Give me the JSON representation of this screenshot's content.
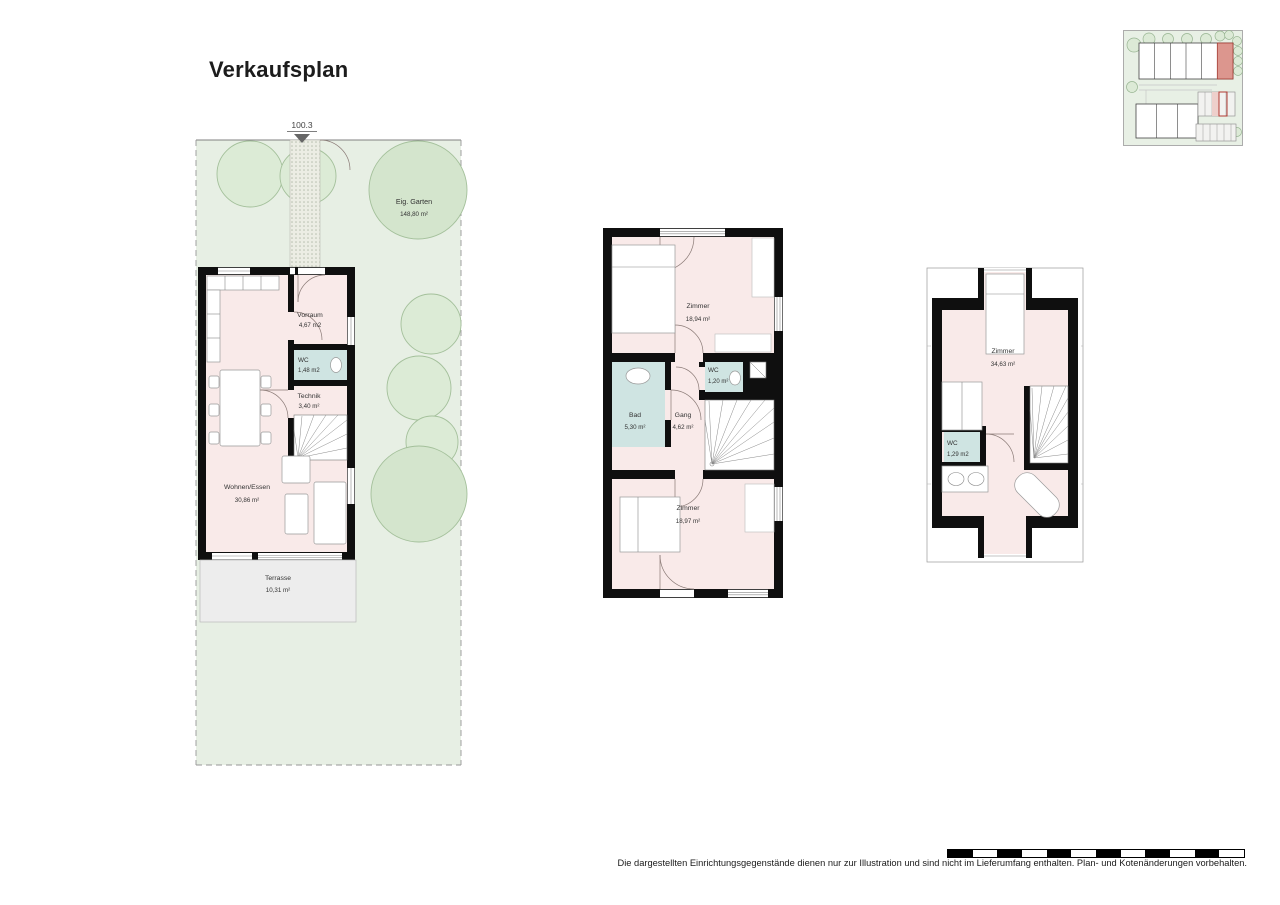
{
  "title": "Verkaufsplan",
  "site_boundary_dimension": "100.3",
  "garden": {
    "name": "Eig. Garten",
    "area": "148,80 m²"
  },
  "ground_floor": {
    "vorraum": {
      "name": "Vorraum",
      "area": "4,67 m2"
    },
    "wc": {
      "name": "WC",
      "area": "1,48 m2"
    },
    "technik": {
      "name": "Technik",
      "area": "3,40 m²"
    },
    "wohnen": {
      "name": "Wohnen/Essen",
      "area": "30,86 m²"
    },
    "terrasse": {
      "name": "Terrasse",
      "area": "10,31 m²"
    }
  },
  "upper_floor": {
    "zimmer1": {
      "name": "Zimmer",
      "area": "18,94 m²"
    },
    "wc": {
      "name": "WC",
      "area": "1,20 m²"
    },
    "bad": {
      "name": "Bad",
      "area": "5,30 m²"
    },
    "gang": {
      "name": "Gang",
      "area": "4,62 m²"
    },
    "zimmer2": {
      "name": "Zimmer",
      "area": "18,97 m²"
    }
  },
  "attic": {
    "zimmer": {
      "name": "Zimmer",
      "area": "34,63 m²"
    },
    "wc": {
      "name": "WC",
      "area": "1,29 m2"
    }
  },
  "disclaimer": "Die dargestellten Einrichtungsgegenstände dienen nur zur Illustration und sind nicht im Lieferumfang enthalten. Plan- und Kotenänderungen vorbehalten.",
  "colors": {
    "wall": "#0f0f0f",
    "room_fill": "#f9eae9",
    "wet_room_fill": "#cfe4e2",
    "garden_fill": "#e7efe4",
    "tree_fill": "#dcebd6",
    "terrace_fill": "#ededed",
    "highlighted_unit": "#dc968e"
  }
}
